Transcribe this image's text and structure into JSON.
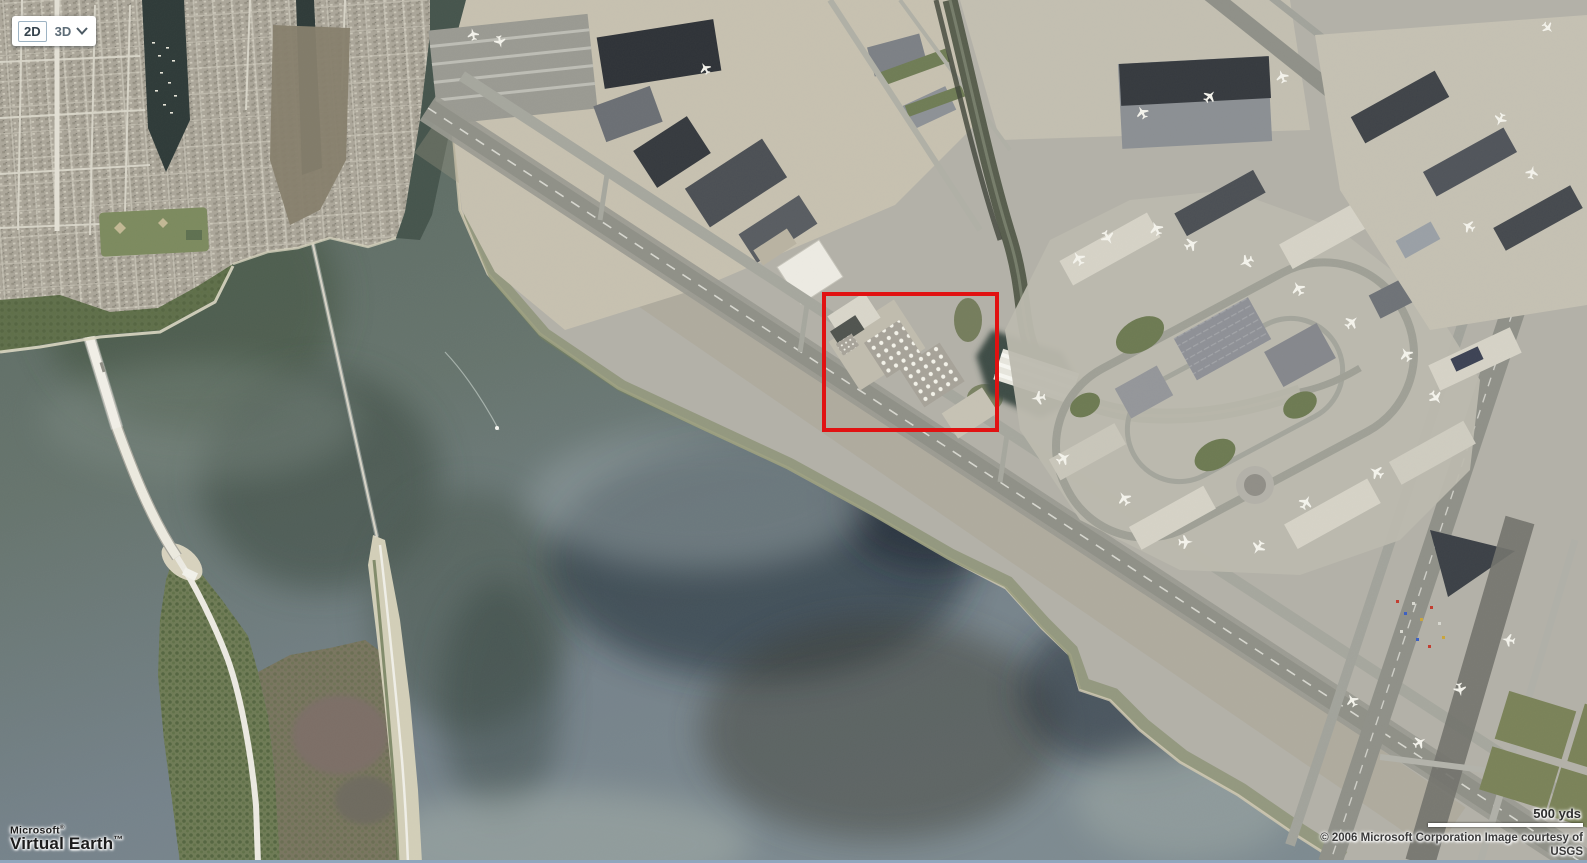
{
  "toolbar": {
    "mode_2d": "2D",
    "mode_3d": "3D"
  },
  "branding": {
    "line1": "Microsoft",
    "line1_mark": "®",
    "line2": "Virtual Earth",
    "line2_mark": "™"
  },
  "scale_bar": {
    "label": "500 yds"
  },
  "attribution": {
    "line1": "© 2006 Microsoft Corporation  Image courtesy of",
    "line2": "USGS"
  },
  "annotation": {
    "box": {
      "left": 822,
      "top": 292,
      "width": 177,
      "height": 140
    },
    "color": "#e11212"
  },
  "map_colors": {
    "water": "#66746d",
    "water_deep": "#1f2b36",
    "airport_land": "#b3b1a8",
    "suburb": "#aba699",
    "vegetation": "#6e7b55",
    "runway": "#8f9087",
    "annotation_red": "#e11212"
  }
}
